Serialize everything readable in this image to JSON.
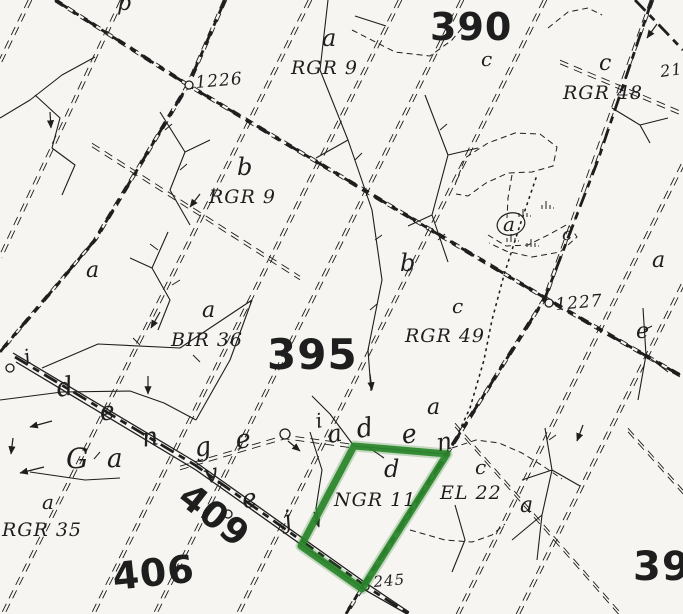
{
  "meta": {
    "description": "Scanned forest stand map with green highlighted stand NGR 11"
  },
  "colors": {
    "paper": "#f6f5f1",
    "ink": "#1e1e1e",
    "highlight": "#2a852a"
  },
  "compartment_numbers": [
    {
      "text": "390",
      "x": 430,
      "y": 40,
      "size": 38,
      "rot": 0
    },
    {
      "text": "395",
      "x": 267,
      "y": 369,
      "size": 42,
      "rot": 0
    },
    {
      "text": "396",
      "x": 633,
      "y": 580,
      "size": 40,
      "rot": 0
    },
    {
      "text": "406",
      "x": 114,
      "y": 590,
      "size": 38,
      "rot": -6
    },
    {
      "text": "409",
      "x": 176,
      "y": 501,
      "size": 36,
      "rot": 38
    }
  ],
  "stand_labels": [
    {
      "text": "RGR 9",
      "x": 291,
      "y": 74,
      "size": 19
    },
    {
      "text": "RGR 48",
      "x": 563,
      "y": 99,
      "size": 19
    },
    {
      "text": "RGR 9",
      "x": 209,
      "y": 203,
      "size": 19
    },
    {
      "text": "BIR 36",
      "x": 171,
      "y": 346,
      "size": 19
    },
    {
      "text": "RGR 49",
      "x": 405,
      "y": 342,
      "size": 19
    },
    {
      "text": "RGR 35",
      "x": 2,
      "y": 536,
      "size": 19
    },
    {
      "text": "NGR 11",
      "x": 334,
      "y": 506,
      "size": 19
    },
    {
      "text": "EL 22",
      "x": 440,
      "y": 499,
      "size": 19
    }
  ],
  "subcompartment_letters": [
    {
      "text": "a",
      "x": 322,
      "y": 46,
      "size": 24
    },
    {
      "text": "c",
      "x": 481,
      "y": 66,
      "size": 20
    },
    {
      "text": "c",
      "x": 599,
      "y": 70,
      "size": 22
    },
    {
      "text": "b",
      "x": 237,
      "y": 175,
      "size": 24
    },
    {
      "text": "b",
      "x": 400,
      "y": 271,
      "size": 24
    },
    {
      "text": "a",
      "x": 86,
      "y": 277,
      "size": 22
    },
    {
      "text": "a",
      "x": 202,
      "y": 317,
      "size": 22
    },
    {
      "text": "c",
      "x": 452,
      "y": 313,
      "size": 20
    },
    {
      "text": "a",
      "x": 427,
      "y": 414,
      "size": 22
    },
    {
      "text": "d",
      "x": 384,
      "y": 477,
      "size": 24
    },
    {
      "text": "c",
      "x": 475,
      "y": 474,
      "size": 20
    },
    {
      "text": "a",
      "x": 520,
      "y": 512,
      "size": 22
    },
    {
      "text": "a",
      "x": 652,
      "y": 267,
      "size": 22
    },
    {
      "text": "e",
      "x": 636,
      "y": 338,
      "size": 22
    },
    {
      "text": "a",
      "x": 42,
      "y": 509,
      "size": 20
    },
    {
      "text": "a",
      "x": 503,
      "y": 231,
      "size": 20
    },
    {
      "text": "c",
      "x": 562,
      "y": 240,
      "size": 18
    },
    {
      "text": "p",
      "x": 117,
      "y": 10,
      "size": 22
    }
  ],
  "road_name_letters": [
    {
      "text": "i",
      "x": 26,
      "y": 364,
      "size": 20,
      "rot": -15
    },
    {
      "text": "d",
      "x": 58,
      "y": 397,
      "size": 26,
      "rot": -10
    },
    {
      "text": "e",
      "x": 101,
      "y": 421,
      "size": 26,
      "rot": -10
    },
    {
      "text": "n",
      "x": 143,
      "y": 447,
      "size": 26,
      "rot": -10
    },
    {
      "text": "G",
      "x": 66,
      "y": 468,
      "size": 28,
      "rot": 0
    },
    {
      "text": "a",
      "x": 107,
      "y": 467,
      "size": 26,
      "rot": 0
    },
    {
      "text": "g",
      "x": 196,
      "y": 457,
      "size": 26,
      "rot": -10
    },
    {
      "text": "e",
      "x": 237,
      "y": 449,
      "size": 26,
      "rot": -10
    },
    {
      "text": "v",
      "x": 206,
      "y": 484,
      "size": 26,
      "rot": -15
    },
    {
      "text": "e",
      "x": 244,
      "y": 509,
      "size": 26,
      "rot": -15
    },
    {
      "text": "j",
      "x": 286,
      "y": 528,
      "size": 24,
      "rot": -15
    },
    {
      "text": "i",
      "x": 317,
      "y": 428,
      "size": 20,
      "rot": -10
    },
    {
      "text": "a",
      "x": 329,
      "y": 443,
      "size": 24,
      "rot": -10
    },
    {
      "text": "d",
      "x": 358,
      "y": 438,
      "size": 26,
      "rot": -10
    },
    {
      "text": "e",
      "x": 403,
      "y": 444,
      "size": 26,
      "rot": -10
    },
    {
      "text": "n",
      "x": 438,
      "y": 451,
      "size": 24,
      "rot": -10
    }
  ],
  "point_numbers": [
    {
      "text": "1226",
      "x": 196,
      "y": 88,
      "size": 17,
      "rot": -5
    },
    {
      "text": "1227",
      "x": 556,
      "y": 310,
      "size": 17,
      "rot": -5
    },
    {
      "text": "212",
      "x": 661,
      "y": 77,
      "size": 16,
      "rot": -8
    },
    {
      "text": "245",
      "x": 374,
      "y": 587,
      "size": 15,
      "rot": -5
    }
  ],
  "highlight_polygon": [
    [
      354,
      446
    ],
    [
      447,
      454
    ],
    [
      362,
      589
    ],
    [
      301,
      546
    ]
  ],
  "circled_letter_outline": {
    "cx": 511,
    "cy": 224,
    "rx": 14,
    "ry": 11,
    "rot": -15
  },
  "heavy_roads": [
    {
      "pts": [
        [
          55,
          0
        ],
        [
          188,
          85
        ],
        [
          545,
          298
        ],
        [
          683,
          377
        ]
      ]
    },
    {
      "pts": [
        [
          225,
          0
        ],
        [
          188,
          85
        ],
        [
          95,
          240
        ],
        [
          0,
          352
        ]
      ]
    },
    {
      "pts": [
        [
          652,
          0
        ],
        [
          598,
          160
        ],
        [
          545,
          298
        ],
        [
          448,
          452
        ],
        [
          362,
          587
        ],
        [
          346,
          614
        ]
      ]
    },
    {
      "pts": [
        [
          15,
          357
        ],
        [
          195,
          465
        ],
        [
          364,
          585
        ],
        [
          409,
          614
        ]
      ]
    },
    {
      "pts": [
        [
          635,
          0
        ],
        [
          660,
          26
        ],
        [
          683,
          50
        ]
      ]
    }
  ],
  "solid_road_lines": [
    {
      "pts": [
        [
          13,
          353
        ],
        [
          194,
          461
        ],
        [
          363,
          581
        ],
        [
          409,
          612
        ]
      ]
    },
    {
      "pts": [
        [
          16,
          362
        ],
        [
          196,
          470
        ],
        [
          365,
          590
        ],
        [
          407,
          614
        ]
      ]
    }
  ],
  "corridor_lines": [
    {
      "pts": [
        [
          30,
          0
        ],
        [
          0,
          62
        ]
      ],
      "off": "x"
    },
    {
      "pts": [
        [
          122,
          0
        ],
        [
          0,
          258
        ]
      ],
      "off": "x"
    },
    {
      "pts": [
        [
          225,
          0
        ],
        [
          188,
          85
        ],
        [
          95,
          240
        ],
        [
          0,
          352
        ]
      ],
      "off": "x"
    },
    {
      "pts": [
        [
          310,
          0
        ],
        [
          3,
          614
        ]
      ],
      "off": "x"
    },
    {
      "pts": [
        [
          400,
          0
        ],
        [
          93,
          614
        ]
      ],
      "off": "x"
    },
    {
      "pts": [
        [
          462,
          0
        ],
        [
          155,
          614
        ]
      ],
      "off": "x"
    },
    {
      "pts": [
        [
          545,
          0
        ],
        [
          238,
          614
        ]
      ],
      "off": "x"
    },
    {
      "pts": [
        [
          683,
          284
        ],
        [
          518,
          614
        ]
      ],
      "off": "x"
    },
    {
      "pts": [
        [
          683,
          164
        ],
        [
          458,
          614
        ]
      ],
      "off": "x"
    },
    {
      "pts": [
        [
          652,
          0
        ],
        [
          545,
          298
        ],
        [
          346,
          614
        ]
      ],
      "off": "x"
    },
    {
      "pts": [
        [
          55,
          0
        ],
        [
          188,
          85
        ],
        [
          545,
          298
        ],
        [
          683,
          377
        ]
      ],
      "off": "y"
    },
    {
      "pts": [
        [
          92,
          145
        ],
        [
          300,
          278
        ]
      ],
      "off": "y"
    },
    {
      "pts": [
        [
          560,
          62
        ],
        [
          683,
          114
        ]
      ],
      "off": "y"
    },
    {
      "pts": [
        [
          455,
          425
        ],
        [
          620,
          614
        ]
      ],
      "off": "y"
    },
    {
      "pts": [
        [
          628,
          430
        ],
        [
          683,
          492
        ]
      ],
      "off": "y"
    },
    {
      "pts": [
        [
          180,
          468
        ],
        [
          285,
          437
        ],
        [
          352,
          446
        ]
      ],
      "off": "y"
    }
  ],
  "thin_lines": [
    {
      "pts": [
        [
          0,
          118
        ],
        [
          30,
          100
        ],
        [
          62,
          75
        ],
        [
          95,
          57
        ]
      ]
    },
    {
      "pts": [
        [
          35,
          95
        ],
        [
          60,
          118
        ],
        [
          52,
          148
        ],
        [
          75,
          165
        ],
        [
          62,
          195
        ]
      ]
    },
    {
      "pts": [
        [
          160,
          112
        ],
        [
          185,
          152
        ],
        [
          170,
          190
        ],
        [
          190,
          225
        ]
      ]
    },
    {
      "pts": [
        [
          185,
          152
        ],
        [
          210,
          140
        ]
      ]
    },
    {
      "pts": [
        [
          168,
          232
        ],
        [
          152,
          268
        ],
        [
          170,
          300
        ],
        [
          158,
          330
        ]
      ]
    },
    {
      "pts": [
        [
          152,
          268
        ],
        [
          130,
          258
        ]
      ]
    },
    {
      "pts": [
        [
          328,
          0
        ],
        [
          320,
          70
        ],
        [
          348,
          140
        ],
        [
          372,
          210
        ],
        [
          382,
          280
        ],
        [
          368,
          350
        ],
        [
          371,
          391
        ]
      ]
    },
    {
      "pts": [
        [
          348,
          140
        ],
        [
          316,
          158
        ]
      ]
    },
    {
      "pts": [
        [
          252,
          300
        ],
        [
          180,
          348
        ],
        [
          98,
          344
        ],
        [
          42,
          368
        ]
      ]
    },
    {
      "pts": [
        [
          0,
          400
        ],
        [
          62,
          392
        ],
        [
          130,
          391
        ],
        [
          164,
          403
        ],
        [
          196,
          420
        ]
      ]
    },
    {
      "pts": [
        [
          196,
          420
        ],
        [
          230,
          360
        ],
        [
          252,
          300
        ]
      ]
    },
    {
      "pts": [
        [
          425,
          95
        ],
        [
          448,
          155
        ],
        [
          432,
          215
        ],
        [
          448,
          262
        ]
      ]
    },
    {
      "pts": [
        [
          448,
          155
        ],
        [
          478,
          148
        ]
      ]
    },
    {
      "pts": [
        [
          432,
          215
        ],
        [
          408,
          226
        ]
      ]
    },
    {
      "pts": [
        [
          643,
          308
        ],
        [
          646,
          355
        ],
        [
          638,
          400
        ]
      ]
    },
    {
      "pts": [
        [
          646,
          355
        ],
        [
          668,
          372
        ]
      ]
    },
    {
      "pts": [
        [
          545,
          428
        ],
        [
          552,
          470
        ],
        [
          542,
          515
        ],
        [
          537,
          560
        ]
      ]
    },
    {
      "pts": [
        [
          552,
          470
        ],
        [
          580,
          486
        ]
      ]
    },
    {
      "pts": [
        [
          552,
          470
        ],
        [
          522,
          480
        ]
      ]
    },
    {
      "pts": [
        [
          542,
          515
        ],
        [
          512,
          540
        ]
      ]
    },
    {
      "pts": [
        [
          310,
          432
        ],
        [
          322,
          470
        ],
        [
          316,
          508
        ],
        [
          319,
          526
        ]
      ]
    },
    {
      "pts": [
        [
          455,
          505
        ],
        [
          465,
          540
        ],
        [
          452,
          572
        ]
      ]
    },
    {
      "pts": [
        [
          612,
          108
        ],
        [
          640,
          125
        ],
        [
          668,
          118
        ]
      ]
    },
    {
      "pts": [
        [
          640,
          125
        ],
        [
          650,
          143
        ]
      ]
    },
    {
      "pts": [
        [
          354,
          446
        ],
        [
          330,
          414
        ],
        [
          312,
          396
        ]
      ]
    },
    {
      "pts": [
        [
          384,
          458
        ],
        [
          368,
          447
        ]
      ]
    },
    {
      "pts": [
        [
          30,
          472
        ],
        [
          85,
          480
        ],
        [
          120,
          478
        ]
      ]
    },
    {
      "pts": [
        [
          355,
          16
        ],
        [
          386,
          26
        ]
      ]
    },
    {
      "pts": [
        [
          354,
          446
        ],
        [
          447,
          454
        ]
      ]
    }
  ],
  "ticks": [
    [
      165,
      130,
      172,
      124
    ],
    [
      180,
      170,
      187,
      164
    ],
    [
      158,
      250,
      150,
      244
    ],
    [
      172,
      285,
      180,
      280
    ],
    [
      355,
      160,
      362,
      153
    ],
    [
      375,
      240,
      382,
      235
    ],
    [
      370,
      310,
      377,
      304
    ],
    [
      200,
      362,
      193,
      355
    ],
    [
      140,
      345,
      133,
      338
    ],
    [
      440,
      130,
      447,
      124
    ],
    [
      438,
      240,
      445,
      234
    ],
    [
      644,
      330,
      652,
      326
    ],
    [
      549,
      440,
      556,
      435
    ],
    [
      100,
      452,
      94,
      459
    ]
  ],
  "dashed_curves": [
    {
      "pts": [
        [
          455,
          185
        ],
        [
          465,
          158
        ],
        [
          488,
          143
        ],
        [
          515,
          133
        ],
        [
          540,
          134
        ],
        [
          557,
          147
        ],
        [
          553,
          166
        ],
        [
          532,
          172
        ],
        [
          508,
          173
        ],
        [
          486,
          183
        ],
        [
          468,
          196
        ],
        [
          456,
          194
        ]
      ]
    },
    {
      "pts": [
        [
          488,
          235
        ],
        [
          506,
          246
        ],
        [
          528,
          245
        ],
        [
          550,
          234
        ],
        [
          568,
          224
        ],
        [
          577,
          237
        ],
        [
          560,
          252
        ],
        [
          532,
          257
        ],
        [
          506,
          251
        ],
        [
          489,
          243
        ]
      ]
    },
    {
      "pts": [
        [
          512,
          175
        ],
        [
          508,
          198
        ],
        [
          507,
          218
        ]
      ]
    },
    {
      "pts": [
        [
          352,
          30
        ],
        [
          395,
          52
        ],
        [
          430,
          56
        ],
        [
          452,
          40
        ],
        [
          462,
          28
        ]
      ]
    },
    {
      "pts": [
        [
          452,
          448
        ],
        [
          476,
          440
        ],
        [
          499,
          443
        ],
        [
          522,
          453
        ],
        [
          543,
          466
        ],
        [
          562,
          479
        ]
      ]
    },
    {
      "pts": [
        [
          410,
          530
        ],
        [
          445,
          540
        ],
        [
          472,
          542
        ],
        [
          492,
          535
        ],
        [
          505,
          524
        ]
      ]
    },
    {
      "pts": [
        [
          548,
          28
        ],
        [
          568,
          12
        ],
        [
          588,
          8
        ],
        [
          602,
          15
        ]
      ]
    }
  ],
  "dotted_lines": [
    {
      "pts": [
        [
          536,
          178
        ],
        [
          520,
          225
        ],
        [
          504,
          275
        ],
        [
          492,
          320
        ],
        [
          484,
          360
        ],
        [
          470,
          408
        ],
        [
          456,
          438
        ]
      ]
    }
  ],
  "flow_arrows": [
    [
      148,
      376,
      148,
      394
    ],
    [
      160,
      312,
      151,
      328
    ],
    [
      200,
      194,
      190,
      207
    ],
    [
      52,
      421,
      30,
      427
    ],
    [
      44,
      467,
      20,
      473
    ],
    [
      13,
      438,
      11,
      454
    ],
    [
      370,
      374,
      372,
      390
    ],
    [
      583,
      425,
      577,
      441
    ],
    [
      314,
      512,
      319,
      527
    ],
    [
      657,
      24,
      647,
      38
    ],
    [
      288,
      441,
      300,
      451
    ],
    [
      50,
      112,
      51,
      128
    ]
  ],
  "point_markers": [
    [
      189,
      85,
      4
    ],
    [
      549,
      303,
      4
    ],
    [
      10,
      368,
      4
    ],
    [
      228,
      514,
      4
    ],
    [
      285,
      434,
      5
    ],
    [
      366,
      587,
      3
    ]
  ],
  "marsh_tufts": [
    [
      523,
      214
    ],
    [
      511,
      239
    ],
    [
      531,
      244
    ],
    [
      546,
      206
    ]
  ]
}
